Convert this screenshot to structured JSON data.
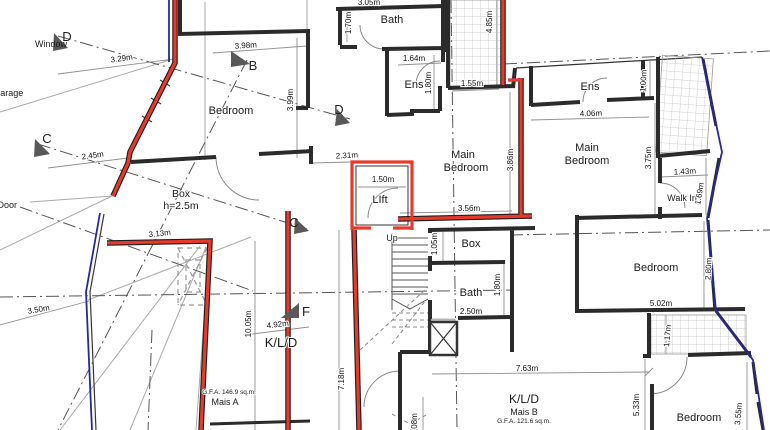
{
  "drawing": {
    "type": "architectural floor plan",
    "units": "m"
  },
  "colors": {
    "highlight_wall_red": "#e8392b",
    "boundary_blue": "#2626a0",
    "wall_black": "#2b2b2b",
    "dimension_text": "#111111"
  },
  "rooms": [
    {
      "label": "Bedroom",
      "x": 231,
      "y": 114,
      "fs": 11
    },
    {
      "label": "Box",
      "x": 181,
      "y": 197,
      "fs": 10.5
    },
    {
      "label": "h=2.5m",
      "x": 181,
      "y": 209,
      "fs": 10.5
    },
    {
      "label": "Bath",
      "x": 392,
      "y": 23,
      "fs": 11
    },
    {
      "label": "Ens",
      "x": 414,
      "y": 88,
      "fs": 11
    },
    {
      "label": "Main",
      "x": 463,
      "y": 158,
      "fs": 11
    },
    {
      "label": "Bedroom",
      "x": 466,
      "y": 171,
      "fs": 11
    },
    {
      "label": "Main",
      "x": 587,
      "y": 151,
      "fs": 11
    },
    {
      "label": "Bedroom",
      "x": 587,
      "y": 164,
      "fs": 11
    },
    {
      "label": "Ens",
      "x": 590,
      "y": 90,
      "fs": 11
    },
    {
      "label": "Walk In",
      "x": 682,
      "y": 201,
      "fs": 9
    },
    {
      "label": "LIft",
      "x": 380,
      "y": 203,
      "fs": 11
    },
    {
      "label": "Box",
      "x": 471,
      "y": 247,
      "fs": 11
    },
    {
      "label": "Bath",
      "x": 471,
      "y": 296,
      "fs": 11
    },
    {
      "label": "Bedroom",
      "x": 656,
      "y": 271,
      "fs": 11
    },
    {
      "label": "Bedroom",
      "x": 699,
      "y": 421,
      "fs": 11
    },
    {
      "label": "K/L/D",
      "x": 281,
      "y": 347,
      "fs": 13
    },
    {
      "label": "K/L/D",
      "x": 524,
      "y": 403,
      "fs": 12
    },
    {
      "label": "Up",
      "x": 392,
      "y": 241,
      "fs": 9
    }
  ],
  "areas": [
    {
      "label": "G.F.A. 146.9 sq.m.",
      "x": 229,
      "y": 394,
      "fs": 6.5
    },
    {
      "label": "Mais A",
      "x": 225,
      "y": 405,
      "fs": 9
    },
    {
      "label": "Mais B",
      "x": 524,
      "y": 415,
      "fs": 9
    },
    {
      "label": "G.F.A. 121.6 sq.m.",
      "x": 524,
      "y": 423,
      "fs": 6.5
    }
  ],
  "annotations": [
    {
      "label": "Window",
      "x": 51,
      "y": 47,
      "fs": 8
    },
    {
      "label": "se: Garage",
      "x": 1,
      "y": 96,
      "fs": 9,
      "anchor": "start"
    },
    {
      "label": "ge Door",
      "x": 1,
      "y": 208,
      "fs": 9,
      "anchor": "start"
    }
  ],
  "section_markers": [
    {
      "letter": "D",
      "x": 67,
      "y": 41
    },
    {
      "letter": "C",
      "x": 47,
      "y": 143
    },
    {
      "letter": "B",
      "x": 253,
      "y": 70
    },
    {
      "letter": "D",
      "x": 339,
      "y": 114
    },
    {
      "letter": "C",
      "x": 294,
      "y": 227
    },
    {
      "letter": "F",
      "x": 306,
      "y": 316
    }
  ],
  "dimensions": [
    {
      "text": "3.29m",
      "x": 122,
      "y": 61,
      "rot": -8
    },
    {
      "text": "3.98m",
      "x": 246,
      "y": 48,
      "rot": -4
    },
    {
      "text": "2.45m",
      "x": 93,
      "y": 158,
      "rot": -8
    },
    {
      "text": "3.05m",
      "x": 369,
      "y": 5,
      "rot": 0
    },
    {
      "text": "1.70m",
      "x": 351,
      "y": 23,
      "rot": -90
    },
    {
      "text": "1.64m",
      "x": 414,
      "y": 61,
      "rot": 0
    },
    {
      "text": "1.80m",
      "x": 431,
      "y": 83,
      "rot": -90
    },
    {
      "text": "1.55m",
      "x": 472,
      "y": 86,
      "rot": 0
    },
    {
      "text": "4.85m",
      "x": 492,
      "y": 22,
      "rot": -90
    },
    {
      "text": "3.99m",
      "x": 293,
      "y": 100,
      "rot": -90
    },
    {
      "text": "2.31m",
      "x": 347,
      "y": 158,
      "rot": -3
    },
    {
      "text": "1.50m",
      "x": 383,
      "y": 182,
      "rot": 0
    },
    {
      "text": "3.56m",
      "x": 469,
      "y": 211,
      "rot": 0
    },
    {
      "text": "3.86m",
      "x": 513,
      "y": 160,
      "rot": -90
    },
    {
      "text": "4.06m",
      "x": 591,
      "y": 116,
      "rot": -2
    },
    {
      "text": "1.00m",
      "x": 646,
      "y": 81,
      "rot": -87
    },
    {
      "text": "3.75m",
      "x": 651,
      "y": 158,
      "rot": -90
    },
    {
      "text": "1.43m",
      "x": 685,
      "y": 174,
      "rot": -3
    },
    {
      "text": "1.69m",
      "x": 702,
      "y": 194,
      "rot": -80
    },
    {
      "text": "1.05m",
      "x": 437,
      "y": 244,
      "rot": -90
    },
    {
      "text": "1.80m",
      "x": 500,
      "y": 285,
      "rot": -90
    },
    {
      "text": "2.50m",
      "x": 471,
      "y": 314,
      "rot": 0
    },
    {
      "text": "3.13m",
      "x": 160,
      "y": 236,
      "rot": -6
    },
    {
      "text": "3.50m",
      "x": 39,
      "y": 312,
      "rot": -10
    },
    {
      "text": "10.05m",
      "x": 251,
      "y": 324,
      "rot": -90
    },
    {
      "text": "4.92m",
      "x": 278,
      "y": 327,
      "rot": -7
    },
    {
      "text": "7.18m",
      "x": 344,
      "y": 379,
      "rot": -90
    },
    {
      "text": "08m",
      "x": 417,
      "y": 421,
      "rot": -90
    },
    {
      "text": "2.80m",
      "x": 711,
      "y": 269,
      "rot": -87
    },
    {
      "text": "5.02m",
      "x": 661,
      "y": 306,
      "rot": 0
    },
    {
      "text": "1.17m",
      "x": 670,
      "y": 336,
      "rot": -85
    },
    {
      "text": "7.63m",
      "x": 527,
      "y": 371,
      "rot": 0
    },
    {
      "text": "5.33m",
      "x": 639,
      "y": 405,
      "rot": -90
    },
    {
      "text": "3.55m",
      "x": 741,
      "y": 414,
      "rot": -85
    }
  ]
}
